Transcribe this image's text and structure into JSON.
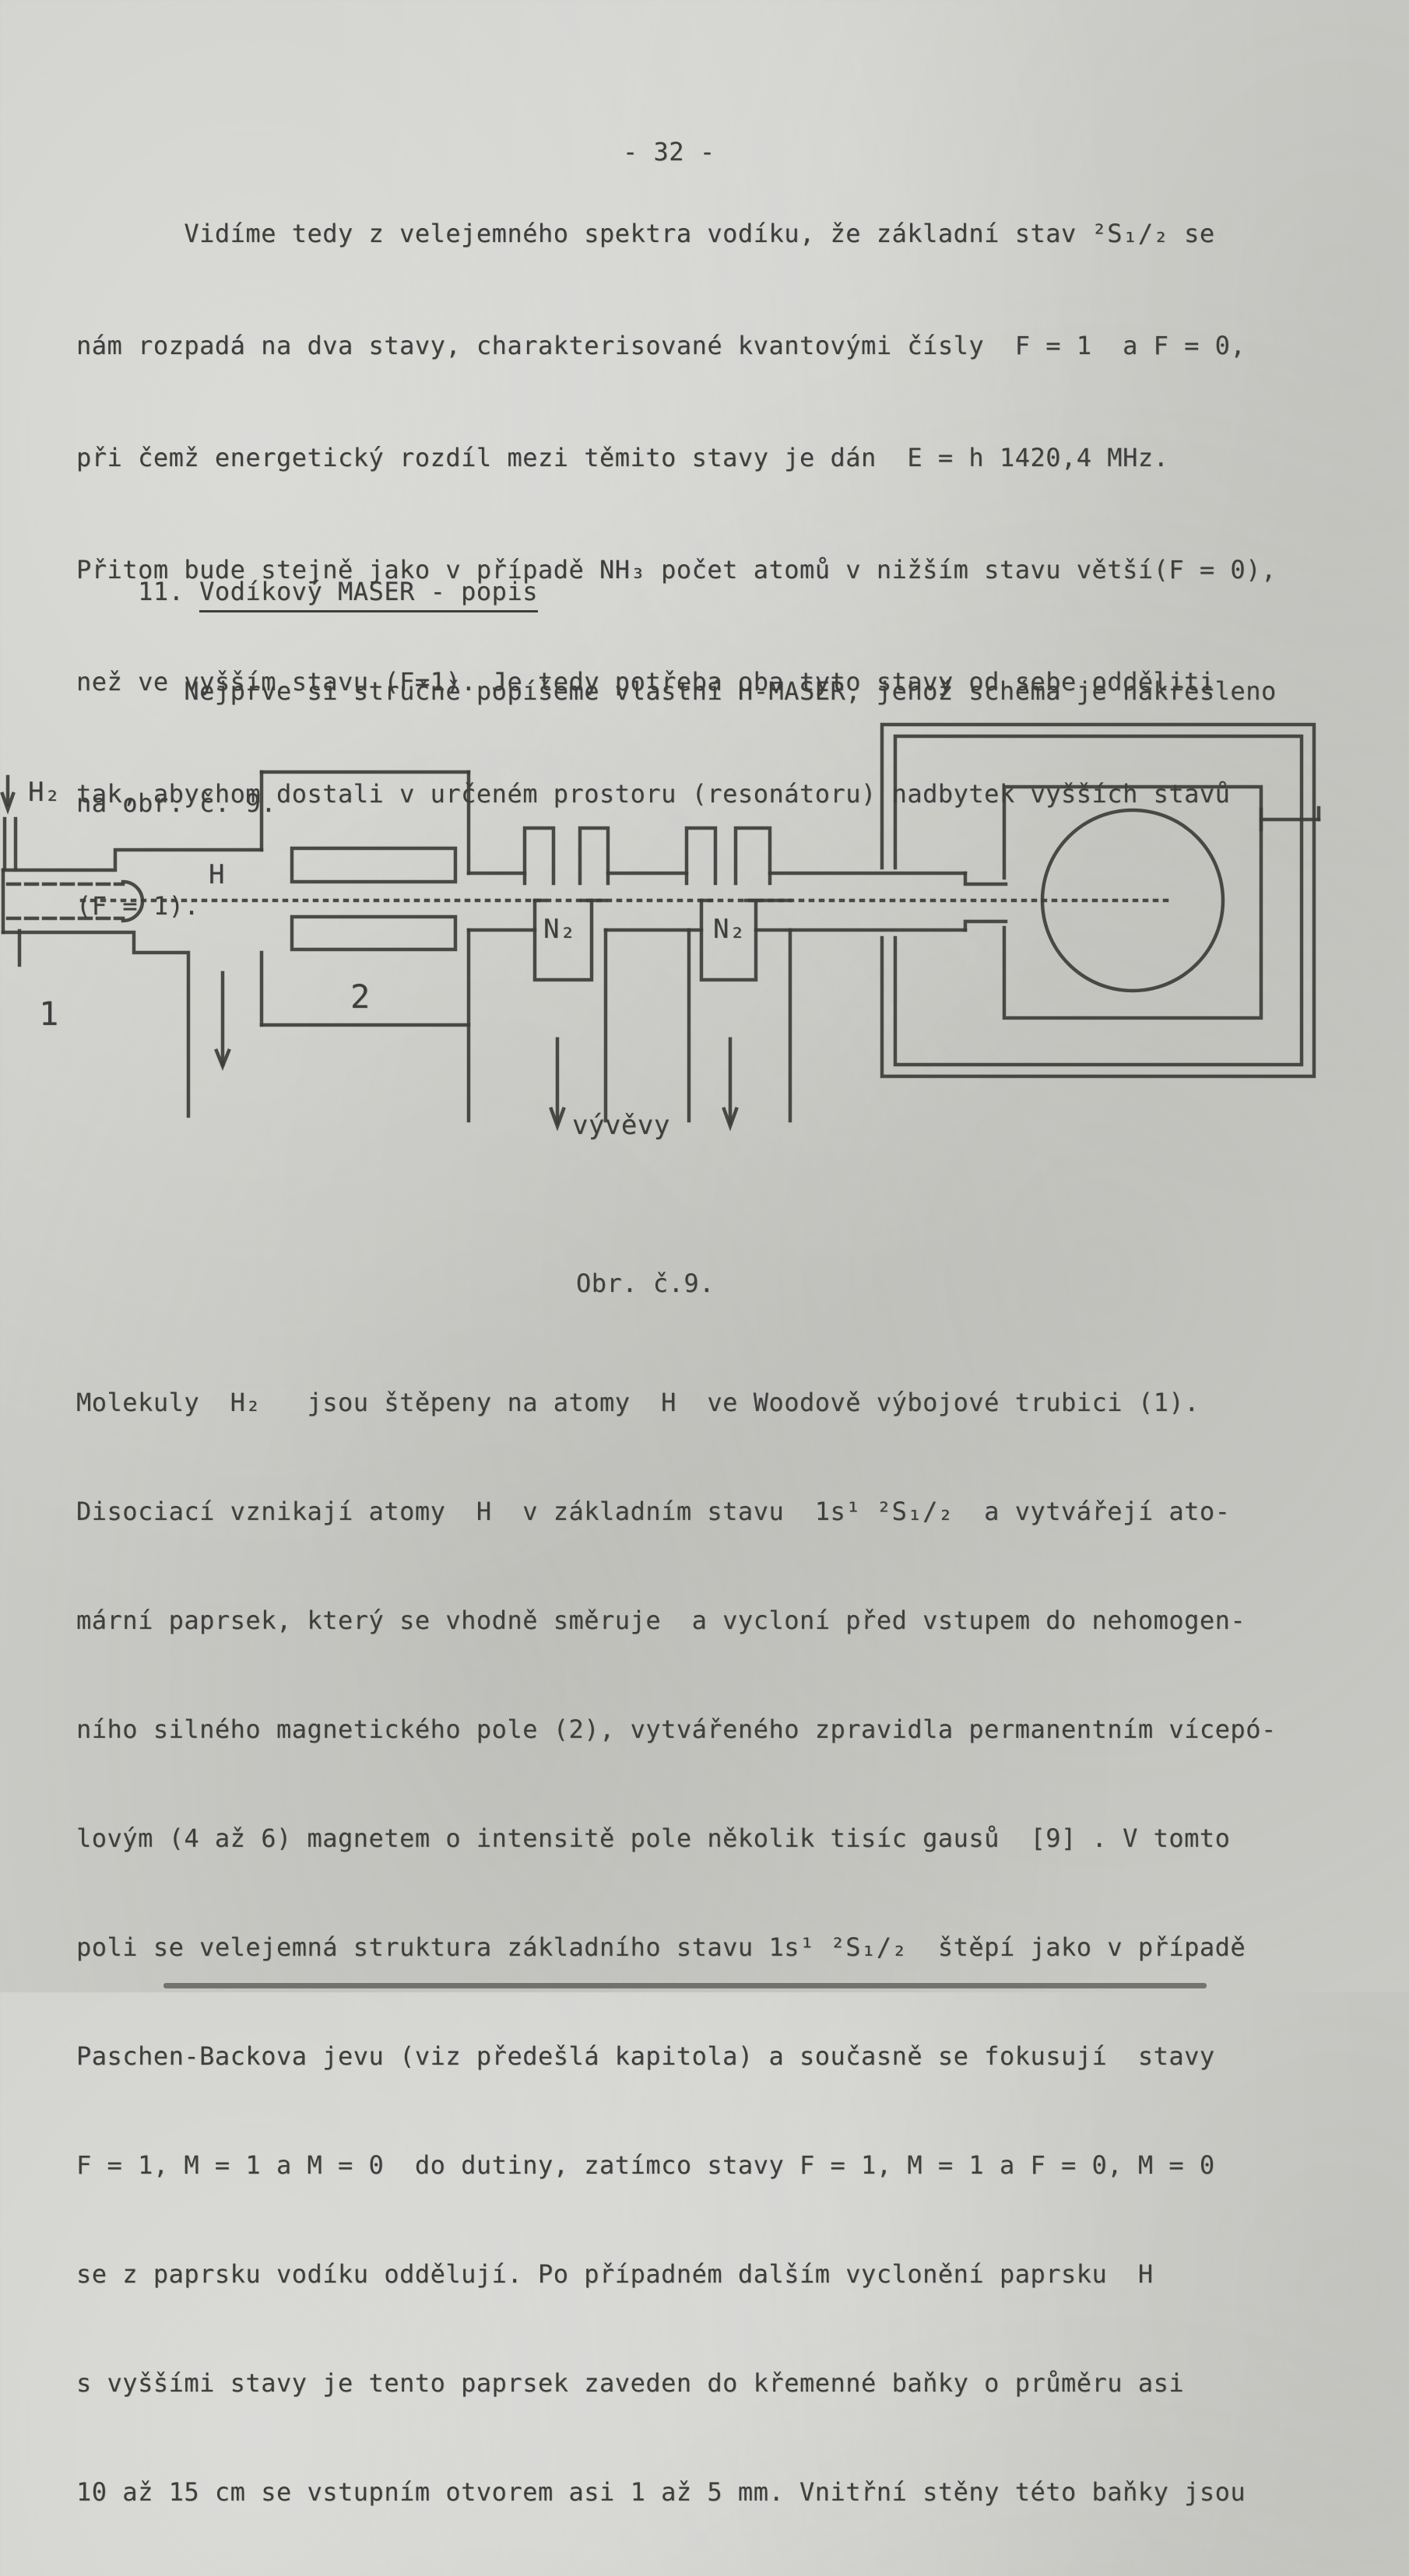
{
  "page": {
    "number": "- 32 -",
    "paragraph1": {
      "lines": [
        "       Vidíme tedy z velejemného spektra vodíku, že základní stav ²S₁/₂ se",
        "nám rozpadá na dva stavy, charakterisované kvantovými čísly  F = 1  a F = 0,",
        "při čemž energetický rozdíl mezi těmito stavy je dán  E = h 1420,4 MHz.",
        "Přitom bude stejně jako v případě NH₃ počet atomů v nižším stavu větší(F = 0),",
        "než ve vyšším stavu (F=1). Je tedy potřeba oba tyto stavy od sebe odděliti",
        "tak, abychom dostali v určeném prostoru (resonátoru) nadbytek vyšších stavů",
        "(F = 1)."
      ]
    },
    "section": {
      "number": "11. ",
      "title": "Vodíkový MASER - popis",
      "intro_lines": [
        "       Nejprve si stručně popíšeme vlastní H-MASER, jehož schéma je nakresleno",
        "na obr. č. 9."
      ]
    },
    "figure": {
      "caption": "Obr. č.9.",
      "labels": {
        "hydrogen_inlet": "H₂",
        "atoms": "H",
        "discharge_tube": "1",
        "magnet": "2",
        "trap1": "N₂",
        "trap2": "N₂",
        "pumps": "vývěvy"
      }
    },
    "paragraph2": {
      "lines": [
        "Molekuly  H₂   jsou štěpeny na atomy  H  ve Woodově výbojové trubici (1).",
        "Disociací vznikají atomy  H  v základním stavu  1s¹ ²S₁/₂  a vytvářejí ato-",
        "mární paprsek, který se vhodně směruje  a vycloní před vstupem do nehomogen-",
        "ního silného magnetického pole (2), vytvářeného zpravidla permanentním vícepó-",
        "lovým (4 až 6) magnetem o intensitě pole několik tisíc gausů  [9] . V tomto",
        "poli se velejemná struktura základního stavu 1s¹ ²S₁/₂  štěpí jako v případě",
        "Paschen-Backova jevu (viz předešlá kapitola) a současně se fokusují  stavy",
        "F = 1, M = 1 a M = 0  do dutiny, zatímco stavy F = 1, M = 1 a F = 0, M = 0",
        "se z paprsku vodíku oddělují. Po případném dalším vyclonění paprsku  H",
        "s vyššími stavy je tento paprsek zaveden do křemenné baňky o průměru asi",
        "10 až 15 cm se vstupním otvorem asi 1 až 5 mm. Vnitřní stěny této baňky jsou"
      ]
    }
  }
}
